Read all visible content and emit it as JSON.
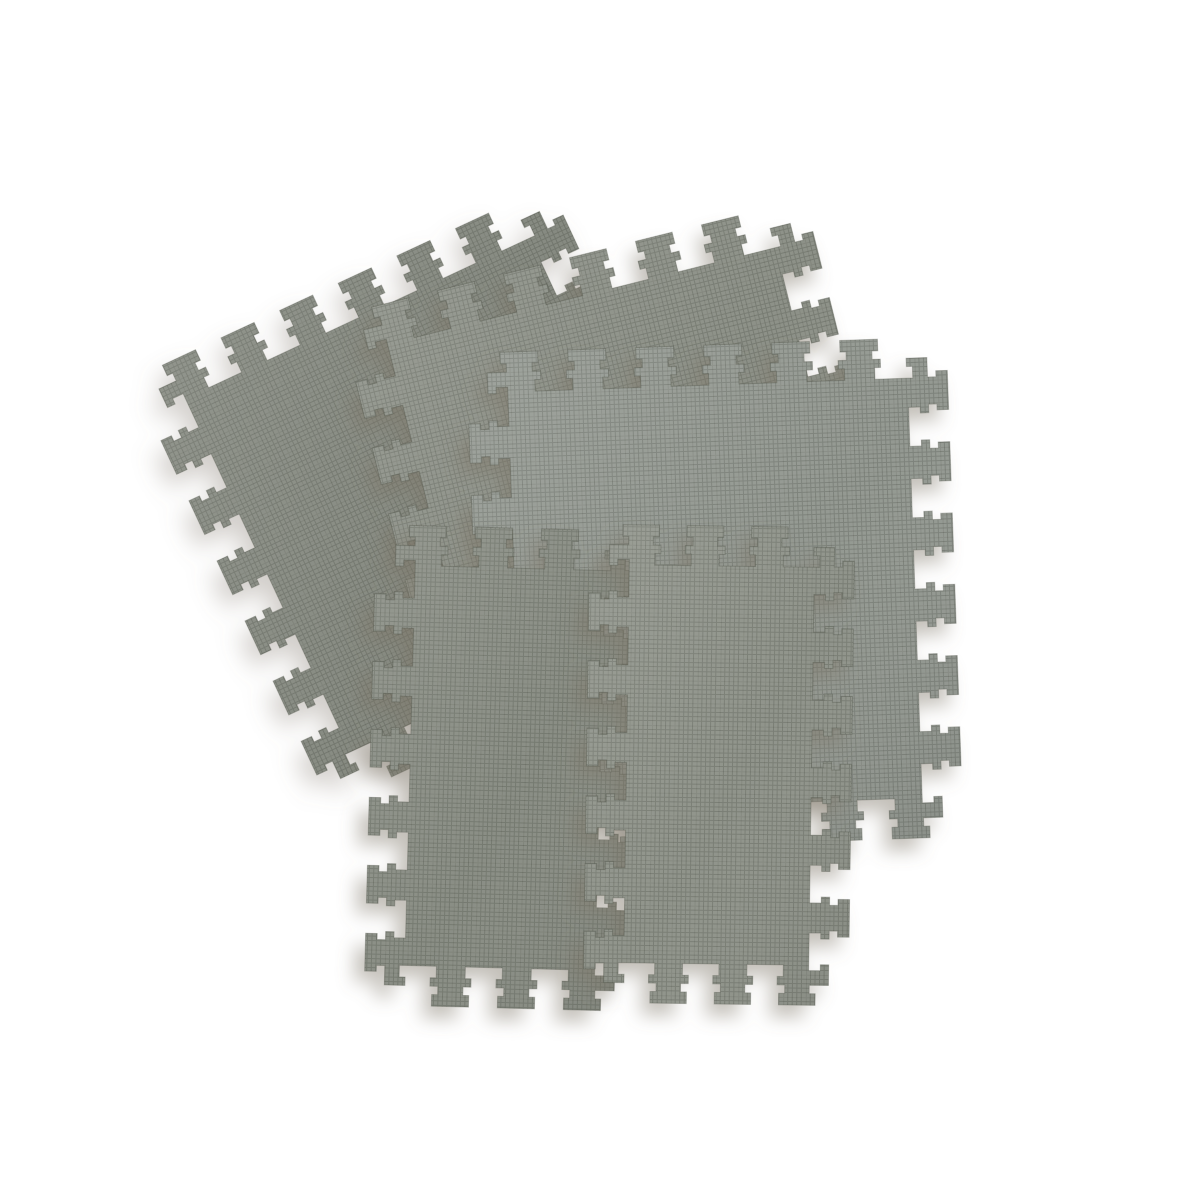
{
  "image": {
    "description": "Product photo: five gray interlocking EVA foam puzzle floor mats (jigsaw-edge exercise tiles) fanned and overlapped on a plain white background",
    "background_color": "#ffffff",
    "shadow_color": "#7d7366",
    "texture": {
      "fine_line_color": "rgba(35,40,30,0.20)",
      "fine_cell": 4.5,
      "coarse_line_color": "rgba(35,40,30,0.10)",
      "coarse_cell": 22.5
    },
    "tooth": {
      "depth": 20,
      "period": 70,
      "flare": 6,
      "corner_margin": 16
    },
    "tiles": [
      {
        "name": "mat-tile-back-left",
        "color": "#868a81",
        "w": 420,
        "h": 430,
        "cx": 440,
        "cy": 495,
        "rot": -25,
        "layer": "back"
      },
      {
        "name": "mat-tile-middle",
        "color": "#8d9188",
        "w": 440,
        "h": 440,
        "cx": 630,
        "cy": 490,
        "rot": -14,
        "layer": "front"
      },
      {
        "name": "mat-tile-right",
        "color": "#949992",
        "w": 440,
        "h": 460,
        "cx": 715,
        "cy": 595,
        "rot": -2,
        "layer": "front"
      },
      {
        "name": "mat-tile-front-left",
        "color": "#8a8e85",
        "w": 230,
        "h": 440,
        "cx": 505,
        "cy": 768,
        "rot": 1.5,
        "layer": "front"
      },
      {
        "name": "mat-tile-front-right",
        "color": "#90948b",
        "w": 225,
        "h": 438,
        "cx": 719,
        "cy": 765,
        "rot": 0.8,
        "layer": "front"
      }
    ]
  }
}
